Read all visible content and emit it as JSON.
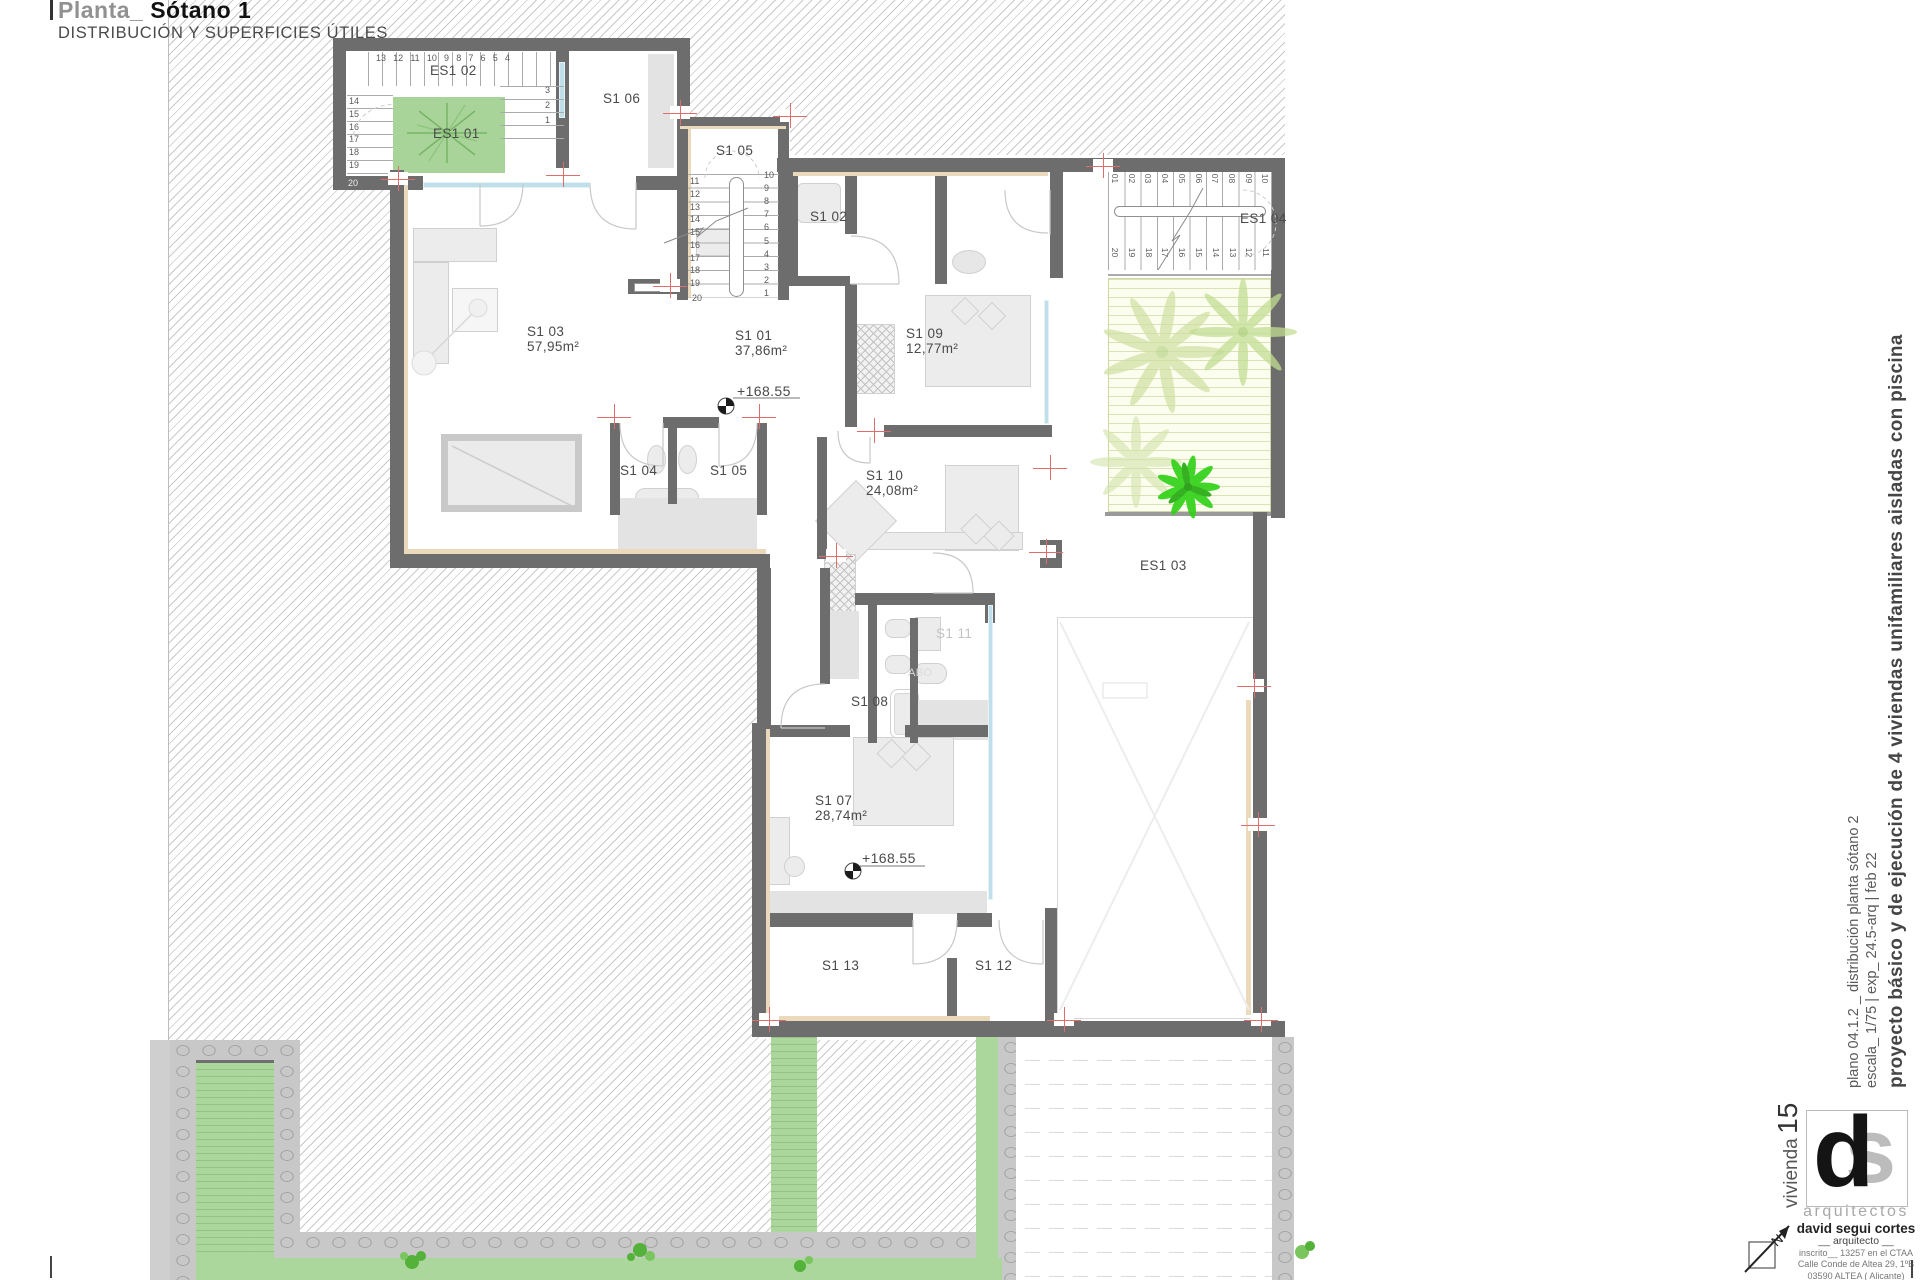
{
  "title": {
    "mark": "|",
    "prefix": "Planta_",
    "name": "Sótano 1",
    "subtitle": "DISTRIBUCIÓN Y SUPERFICIES ÚTILES"
  },
  "rooms": {
    "es1_02": "ES1 02",
    "es1_01": "ES1 01",
    "s1_06": "S1 06",
    "s1_05_stair": "S1 05",
    "s1_02": "S1 02",
    "es1_04": "ES1 04",
    "s1_03": {
      "name": "S1 03",
      "area": "57,95m²"
    },
    "s1_01": {
      "name": "S1 01",
      "area": "37,86m²"
    },
    "s1_09": {
      "name": "S1 09",
      "area": "12,77m²"
    },
    "s1_10": {
      "name": "S1 10",
      "area": "24,08m²"
    },
    "s1_07": {
      "name": "S1 07",
      "area": "28,74m²"
    },
    "s1_04": "S1 04",
    "s1_05_bath": "S1 05",
    "es1_03": "ES1 03",
    "s1_11": "S1 11",
    "s1_08": "S1 08",
    "s1_13": "S1 13",
    "s1_12": "S1 12",
    "faint_text": "ABO"
  },
  "levels": {
    "marker_1": "+168.55",
    "marker_2": "+168.55"
  },
  "stairs": {
    "es1_02": {
      "top": [
        "13",
        "12",
        "11",
        "10",
        "9",
        "8",
        "7",
        "6",
        "5",
        "4"
      ],
      "left": [
        "14",
        "15",
        "16",
        "17",
        "18",
        "19"
      ],
      "bottom": "20",
      "right": [
        "3",
        "2",
        "1"
      ]
    },
    "s1_05": {
      "left": [
        "11",
        "12",
        "13",
        "14",
        "15",
        "16",
        "17",
        "18",
        "19"
      ],
      "bottom": "20",
      "right": [
        "10",
        "9",
        "8",
        "7",
        "6",
        "5",
        "4",
        "3",
        "2",
        "1"
      ]
    },
    "es1_04": {
      "top": [
        "01",
        "02",
        "03",
        "04",
        "05",
        "06",
        "07",
        "08",
        "09",
        "10"
      ],
      "bottom": [
        "20",
        "19",
        "18",
        "17",
        "16",
        "15",
        "14",
        "13",
        "12",
        "11"
      ]
    }
  },
  "margin": {
    "project": "proyecto básico y de ejecución de 4 viviendas unifamiliares aisladas con piscina",
    "plan": "plano 04.1.2 _ distribución planta sótano 2",
    "scale": "escala_ 1/75  |  exp_ 24.5-arq  |  feb 22"
  },
  "titleblock": {
    "house_label": "vivienda",
    "house_number": "15",
    "logo_d": "d",
    "logo_s": "s",
    "studio": "arquitectos",
    "architect": "david segui cortes",
    "role": "__ arquitecto __",
    "registration": "inscrito__ 13257 en el CTAA",
    "address_line1": "Calle Conde de Altea 29, 1ºB",
    "address_line2": "03590 ALTEA  ( Alicante)",
    "email": "info@davidseguiarquitectos.com",
    "north_letter": "N"
  },
  "colors": {
    "wall": "#6d6d6d",
    "lining": "#ead9ba",
    "glass": "#bfe0ea",
    "planter_green": "#a8d49a",
    "garden_green": "#abd69c",
    "stone": "#c8c8c8",
    "marker_red": "#e06d6d",
    "bright_plant": "#2fd114"
  }
}
